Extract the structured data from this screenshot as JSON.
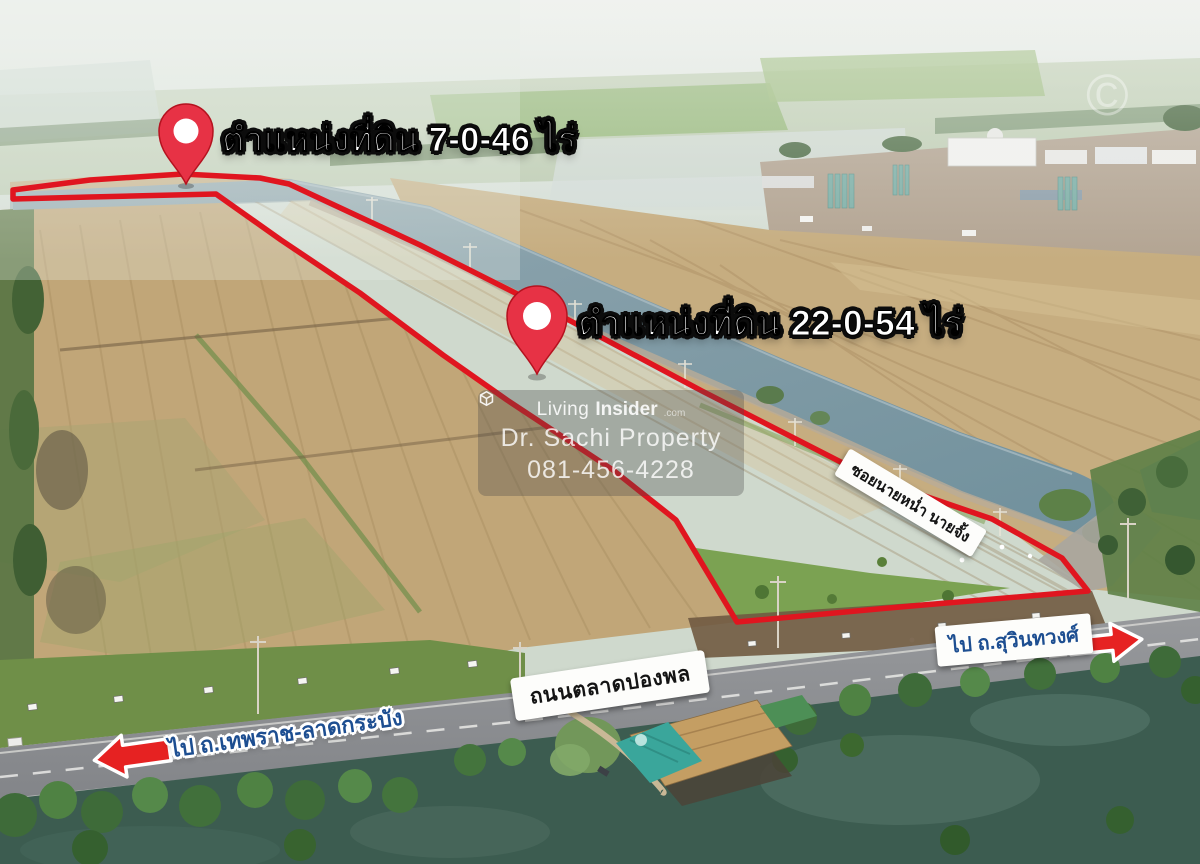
{
  "annotations": {
    "parcel1_label": "ตำแหน่งที่ดิน 7-0-46 ไร่",
    "parcel2_label": "ตำแหน่งที่ดิน 22-0-54 ไร่",
    "soi_sign": "ซอยนายหน่ำ นายจั้ง",
    "road_sign": "ถนนตลาดปองพล",
    "direction_left": "ไป ถ.เทพราช-ลาดกระบัง",
    "direction_right": "ไป ถ.สุวินทวงศ์",
    "copyright_mark": "©"
  },
  "watermark": {
    "brand_prefix": "Living",
    "brand_suffix": "Insider",
    "brand_tld": ".com",
    "agent_name": "Dr. Sachi Property",
    "phone": "081-456-4228"
  },
  "colors": {
    "boundary_red": "#e0151f",
    "pin_red": "#e73245",
    "arrow_red": "#e62222",
    "direction_text_blue": "#1d4e91",
    "canal_water": "#7f96a1",
    "field_tan": "#c2a87a",
    "pond_green": "#3c5c50"
  }
}
